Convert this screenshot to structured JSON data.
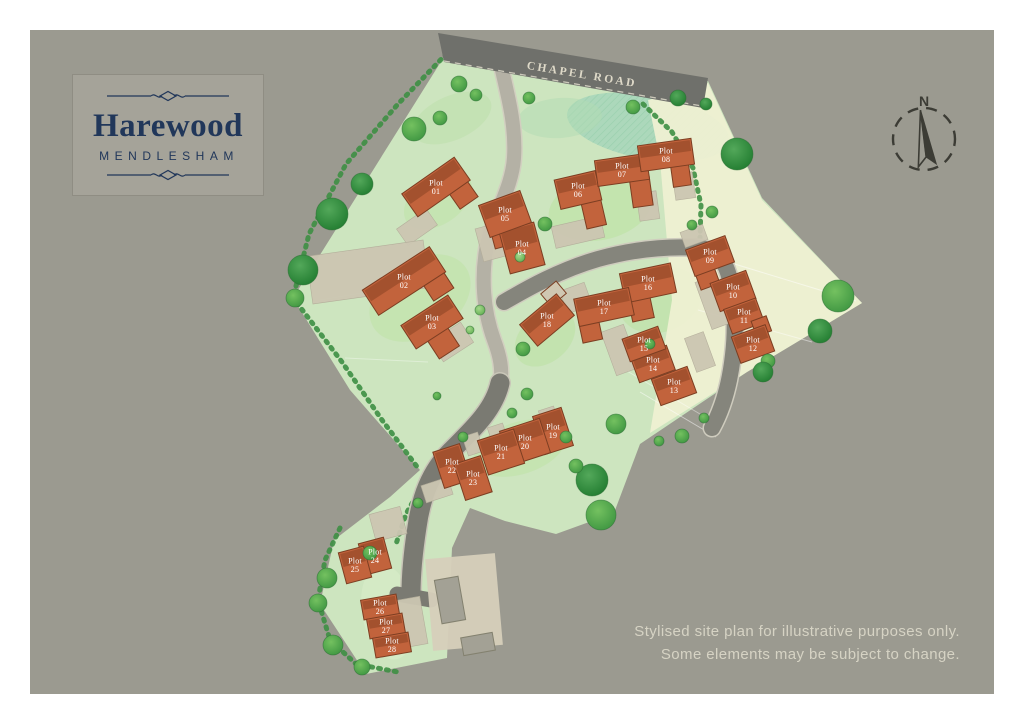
{
  "branding": {
    "title": "Harewood",
    "subtitle": "MENDLESHAM"
  },
  "disclaimer": {
    "line1": "Stylised site plan for illustrative purposes only.",
    "line2": "Some elements may be subject to change."
  },
  "map": {
    "road_label": "CHAPEL ROAD",
    "compass_label": "N",
    "plot_word": "Plot",
    "colors": {
      "canvas_bg": "#9b9a90",
      "site_green": "#cde5bf",
      "fields_cream": "#eef0d2",
      "house": "#c2633c",
      "house_roof": "#9d4e2c",
      "house_outline": "#7c3e22",
      "drive": "#ccc6b2",
      "court": "#d6cfba",
      "barn": "#a3a195",
      "road_dark": "#6f706b",
      "road_mid": "#85857c",
      "road_light": "#b4b1a5",
      "label_text": "#ffffff",
      "brand_navy": "#21375a"
    },
    "plots": [
      {
        "number": "01",
        "x": 436,
        "y": 187,
        "w": 64,
        "h": 28,
        "rot": -35,
        "wing": {
          "dx": 18,
          "dy": 20,
          "w": 22,
          "h": 24
        }
      },
      {
        "number": "02",
        "x": 404,
        "y": 281,
        "w": 80,
        "h": 30,
        "rot": -33,
        "wing": {
          "dx": 26,
          "dy": 18,
          "w": 24,
          "h": 30
        }
      },
      {
        "number": "03",
        "x": 432,
        "y": 322,
        "w": 56,
        "h": 28,
        "rot": -33,
        "wing": {
          "dx": -2,
          "dy": 24,
          "w": 24,
          "h": 22
        }
      },
      {
        "number": "04",
        "x": 522,
        "y": 248,
        "w": 36,
        "h": 44,
        "rot": -15,
        "wing": {
          "dx": -14,
          "dy": -16,
          "w": 24,
          "h": 20
        }
      },
      {
        "number": "05",
        "x": 505,
        "y": 214,
        "w": 44,
        "h": 34,
        "rot": -20
      },
      {
        "number": "06",
        "x": 578,
        "y": 190,
        "w": 42,
        "h": 30,
        "rot": -13,
        "wing": {
          "dx": 10,
          "dy": 26,
          "w": 20,
          "h": 28
        }
      },
      {
        "number": "07",
        "x": 622,
        "y": 170,
        "w": 52,
        "h": 26,
        "rot": -8,
        "wing": {
          "dx": 16,
          "dy": 24,
          "w": 20,
          "h": 30
        }
      },
      {
        "number": "08",
        "x": 666,
        "y": 155,
        "w": 54,
        "h": 26,
        "rot": -8,
        "wing": {
          "dx": 12,
          "dy": 22,
          "w": 18,
          "h": 22
        }
      },
      {
        "number": "09",
        "x": 710,
        "y": 256,
        "w": 42,
        "h": 28,
        "rot": -20,
        "wing": {
          "dx": -10,
          "dy": 20,
          "w": 20,
          "h": 18
        }
      },
      {
        "number": "10",
        "x": 733,
        "y": 291,
        "w": 38,
        "h": 30,
        "rot": -20
      },
      {
        "number": "11",
        "x": 744,
        "y": 316,
        "w": 34,
        "h": 26,
        "rot": -20
      },
      {
        "number": "12",
        "x": 753,
        "y": 344,
        "w": 36,
        "h": 28,
        "rot": -20,
        "wing": {
          "dx": 14,
          "dy": -14,
          "w": 16,
          "h": 16
        }
      },
      {
        "number": "13",
        "x": 674,
        "y": 386,
        "w": 38,
        "h": 28,
        "rot": -20
      },
      {
        "number": "14",
        "x": 653,
        "y": 364,
        "w": 38,
        "h": 26,
        "rot": -20
      },
      {
        "number": "15",
        "x": 644,
        "y": 344,
        "w": 38,
        "h": 24,
        "rot": -20
      },
      {
        "number": "16",
        "x": 648,
        "y": 283,
        "w": 52,
        "h": 30,
        "rot": -12,
        "wing": {
          "dx": -12,
          "dy": 22,
          "w": 22,
          "h": 26
        }
      },
      {
        "number": "17",
        "x": 604,
        "y": 307,
        "w": 56,
        "h": 28,
        "rot": -12,
        "wing": {
          "dx": -18,
          "dy": 20,
          "w": 20,
          "h": 22
        }
      },
      {
        "number": "18",
        "x": 547,
        "y": 320,
        "w": 48,
        "h": 28,
        "rot": -40,
        "wing": {
          "dx": 22,
          "dy": -16,
          "w": 20,
          "h": 16,
          "fill": "#cfc7b2"
        }
      },
      {
        "number": "19",
        "x": 553,
        "y": 431,
        "w": 30,
        "h": 40,
        "rot": -18
      },
      {
        "number": "20",
        "x": 525,
        "y": 442,
        "w": 42,
        "h": 36,
        "rot": -18
      },
      {
        "number": "21",
        "x": 501,
        "y": 452,
        "w": 38,
        "h": 36,
        "rot": -18
      },
      {
        "number": "22",
        "x": 452,
        "y": 466,
        "w": 28,
        "h": 38,
        "rot": -18
      },
      {
        "number": "23",
        "x": 473,
        "y": 478,
        "w": 28,
        "h": 38,
        "rot": -18
      },
      {
        "number": "24",
        "x": 375,
        "y": 556,
        "w": 26,
        "h": 32,
        "rot": -15
      },
      {
        "number": "25",
        "x": 355,
        "y": 565,
        "w": 26,
        "h": 32,
        "rot": -15
      },
      {
        "number": "26",
        "x": 380,
        "y": 607,
        "w": 36,
        "h": 20,
        "rot": -10
      },
      {
        "number": "27",
        "x": 386,
        "y": 626,
        "w": 36,
        "h": 20,
        "rot": -10
      },
      {
        "number": "28",
        "x": 392,
        "y": 645,
        "w": 36,
        "h": 20,
        "rot": -10
      }
    ],
    "trees": [
      [
        362,
        184,
        11,
        "dark"
      ],
      [
        332,
        214,
        16,
        "dark"
      ],
      [
        303,
        270,
        15,
        "dark"
      ],
      [
        295,
        298,
        9,
        "mid"
      ],
      [
        414,
        129,
        12,
        "mid"
      ],
      [
        440,
        118,
        7,
        "mid"
      ],
      [
        459,
        84,
        8,
        "mid"
      ],
      [
        476,
        95,
        6,
        "mid"
      ],
      [
        529,
        98,
        6,
        "mid"
      ],
      [
        545,
        224,
        7,
        "mid"
      ],
      [
        520,
        257,
        5,
        "light"
      ],
      [
        633,
        107,
        7,
        "mid"
      ],
      [
        678,
        98,
        8,
        "dark"
      ],
      [
        706,
        104,
        6,
        "dark"
      ],
      [
        737,
        154,
        16,
        "dark"
      ],
      [
        712,
        212,
        6,
        "mid"
      ],
      [
        692,
        225,
        5,
        "mid"
      ],
      [
        838,
        296,
        16,
        "mid"
      ],
      [
        820,
        331,
        12,
        "dark"
      ],
      [
        768,
        361,
        7,
        "mid"
      ],
      [
        763,
        372,
        10,
        "dark"
      ],
      [
        682,
        436,
        7,
        "mid"
      ],
      [
        659,
        441,
        5,
        "mid"
      ],
      [
        592,
        480,
        16,
        "dark"
      ],
      [
        601,
        515,
        15,
        "mid"
      ],
      [
        576,
        466,
        7,
        "mid"
      ],
      [
        616,
        424,
        10,
        "mid"
      ],
      [
        523,
        349,
        7,
        "mid"
      ],
      [
        527,
        394,
        6,
        "mid"
      ],
      [
        512,
        413,
        5,
        "mid"
      ],
      [
        566,
        437,
        6,
        "mid"
      ],
      [
        463,
        437,
        5,
        "mid"
      ],
      [
        437,
        396,
        4,
        "mid"
      ],
      [
        480,
        310,
        5,
        "light"
      ],
      [
        470,
        330,
        4,
        "light"
      ],
      [
        650,
        344,
        5,
        "mid"
      ],
      [
        704,
        418,
        5,
        "mid"
      ],
      [
        370,
        553,
        7,
        "mid"
      ],
      [
        327,
        578,
        10,
        "mid"
      ],
      [
        318,
        603,
        9,
        "mid"
      ],
      [
        333,
        645,
        10,
        "mid"
      ],
      [
        362,
        667,
        8,
        "mid"
      ],
      [
        418,
        503,
        5,
        "mid"
      ]
    ],
    "driveways": [
      [
        417,
        227,
        36,
        20,
        -35
      ],
      [
        368,
        272,
        118,
        48,
        -8
      ],
      [
        452,
        342,
        36,
        24,
        -33
      ],
      [
        492,
        242,
        26,
        34,
        -15
      ],
      [
        578,
        232,
        50,
        22,
        -13
      ],
      [
        648,
        206,
        20,
        28,
        -8
      ],
      [
        684,
        186,
        20,
        26,
        -8
      ],
      [
        694,
        236,
        24,
        16,
        -20
      ],
      [
        712,
        303,
        18,
        50,
        -20
      ],
      [
        700,
        352,
        20,
        36,
        -20
      ],
      [
        620,
        350,
        24,
        46,
        -20
      ],
      [
        576,
        298,
        26,
        24,
        -20
      ],
      [
        549,
        418,
        16,
        20,
        -18
      ],
      [
        498,
        435,
        16,
        20,
        -18
      ],
      [
        473,
        444,
        16,
        20,
        -18
      ],
      [
        437,
        490,
        28,
        18,
        -18
      ],
      [
        388,
        524,
        32,
        28,
        -15
      ],
      [
        412,
        622,
        24,
        48,
        -10
      ]
    ],
    "courtyard": [
      464,
      602,
      70,
      92,
      -5
    ],
    "barns": [
      [
        450,
        600,
        24,
        44,
        -10
      ],
      [
        478,
        644,
        32,
        18,
        -10
      ]
    ]
  }
}
